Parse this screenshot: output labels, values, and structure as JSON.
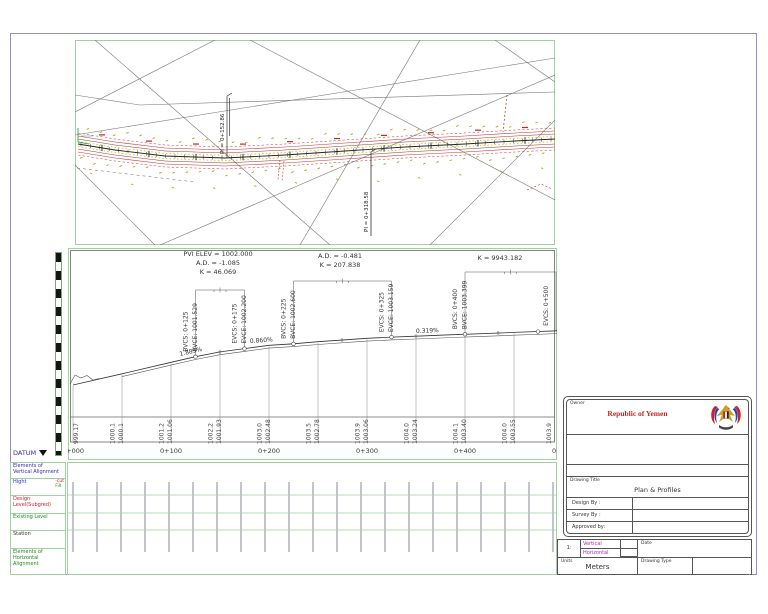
{
  "colors": {
    "sheet_border": "#9191c1",
    "panel_green": "#9fd29f",
    "red": "#cc2222",
    "green": "#1a8a1a",
    "blue": "#2d2db4",
    "magenta": "#bb22bb",
    "road_red": "#cc3333",
    "olive": "#b8a000"
  },
  "plan": {
    "pi_labels": [
      "PI = 0+152.86",
      "PI = 0+318.58"
    ]
  },
  "profile": {
    "pvi_annotations": [
      {
        "lines": [
          "PVI ELEV = 1002.000",
          "A.D. = -1.085",
          "K = 46.069"
        ]
      },
      {
        "lines": [
          "A.D. = -0.481",
          "K = 207.838"
        ]
      },
      {
        "lines": [
          "K = 9943.182"
        ]
      }
    ],
    "vc_points": [
      {
        "sta": "0+125",
        "labels": [
          "BVCS: 0+125",
          "BVCE: 1001.529"
        ]
      },
      {
        "sta": "0+175",
        "labels": [
          "EVCS: 0+175",
          "EVCE: 1002.200"
        ]
      },
      {
        "sta": "0+225",
        "labels": [
          "BVCS: 0+225",
          "BVCE: 1002.600"
        ]
      },
      {
        "sta": "0+325",
        "labels": [
          "EVCS: 0+325",
          "EVCE: 1003.159"
        ]
      },
      {
        "sta": "0+400",
        "labels": [
          "BVCS: 0+400",
          "BVCE: 1003.399"
        ]
      },
      {
        "sta": "0+500",
        "labels": [
          "EVCS: 0+500"
        ]
      }
    ],
    "grades": [
      "1.885%",
      "0.860%",
      "0.319%"
    ],
    "stations": [
      {
        "sta": "0+000",
        "existing": "999.17",
        "design": ""
      },
      {
        "sta": "0+050",
        "existing": "1000.1",
        "design": "1000.1"
      },
      {
        "sta": "0+100",
        "existing": "1001.2",
        "design": "1001.06"
      },
      {
        "sta": "0+150",
        "existing": "1002.2",
        "design": "1001.93"
      },
      {
        "sta": "0+200",
        "existing": "1003.0",
        "design": "1002.48"
      },
      {
        "sta": "0+250",
        "existing": "1003.5",
        "design": "1002.78"
      },
      {
        "sta": "0+300",
        "existing": "1003.9",
        "design": "1003.06"
      },
      {
        "sta": "0+350",
        "existing": "1004.0",
        "design": "1003.24"
      },
      {
        "sta": "0+400",
        "existing": "1004.1",
        "design": "1003.40"
      },
      {
        "sta": "0+450",
        "existing": "1004.0",
        "design": "1003.55"
      },
      {
        "sta": "0+500",
        "existing": "1003.9",
        "design": ""
      }
    ],
    "major_station_labels": [
      "0+000",
      "0+100",
      "0+200",
      "0+300",
      "0+400",
      "0+500"
    ]
  },
  "left_panel": {
    "datum_label": "DATUM",
    "rows": [
      {
        "label": "Elements of Vertical Alignment"
      },
      {
        "label": "Hight",
        "extra_cut": "-cut",
        "extra_fill": "Fill"
      },
      {
        "label": "Design Level(Subgred)"
      },
      {
        "label": "Existing Level"
      },
      {
        "label": "Station"
      },
      {
        "label": "Elements of Horizontal Alignment"
      }
    ]
  },
  "title_block": {
    "owner_label": "Owner",
    "country": "Republic of Yemen",
    "drawing_title_label": "Drawing Title",
    "drawing_title": "Plan & Profiles",
    "design_by": "Design By :",
    "survey_by": "Survey By :",
    "approved_by": "Approved by:",
    "scale_value": "1:",
    "vertical_label": "Vertical",
    "horizontal_label": "Horizontal",
    "date_label": "Date",
    "units_label": "Units",
    "units_value": "Meters",
    "drawing_type_label": "Drawing Type"
  }
}
